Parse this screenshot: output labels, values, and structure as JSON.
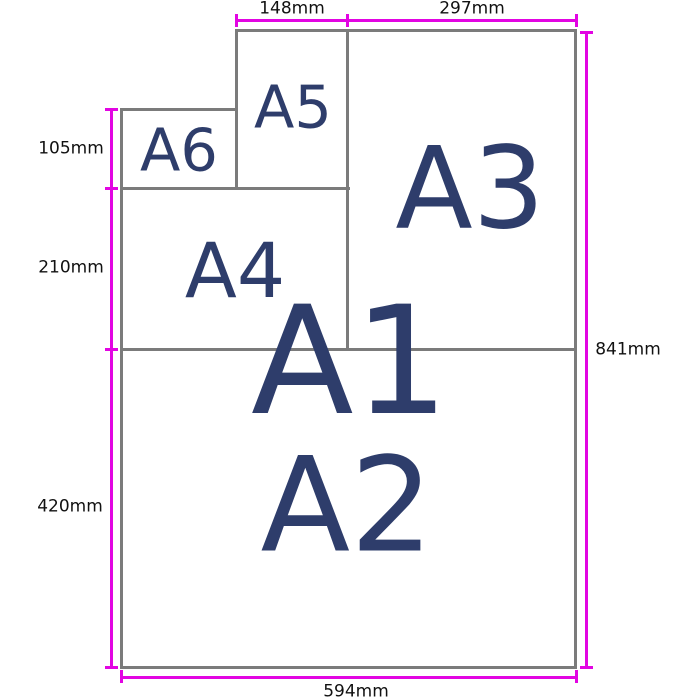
{
  "diagram": {
    "description": "ISO A-series paper sizes diagram",
    "paper_labels": {
      "a1": "A1",
      "a2": "A2",
      "a3": "A3",
      "a4": "A4",
      "a5": "A5",
      "a6": "A6"
    },
    "dim_labels": {
      "a5_width": "148mm",
      "a3_width": "297mm",
      "a6_height": "105mm",
      "a4_height": "210mm",
      "a2_height": "420mm",
      "a1_height": "841mm",
      "a1_width": "594mm"
    },
    "colors": {
      "paper_border": "#7b7b7b",
      "dimension_line": "#e205e2",
      "paper_label_color": "#2e3d6b",
      "dim_label_color": "#111111",
      "background": "#ffffff"
    }
  }
}
